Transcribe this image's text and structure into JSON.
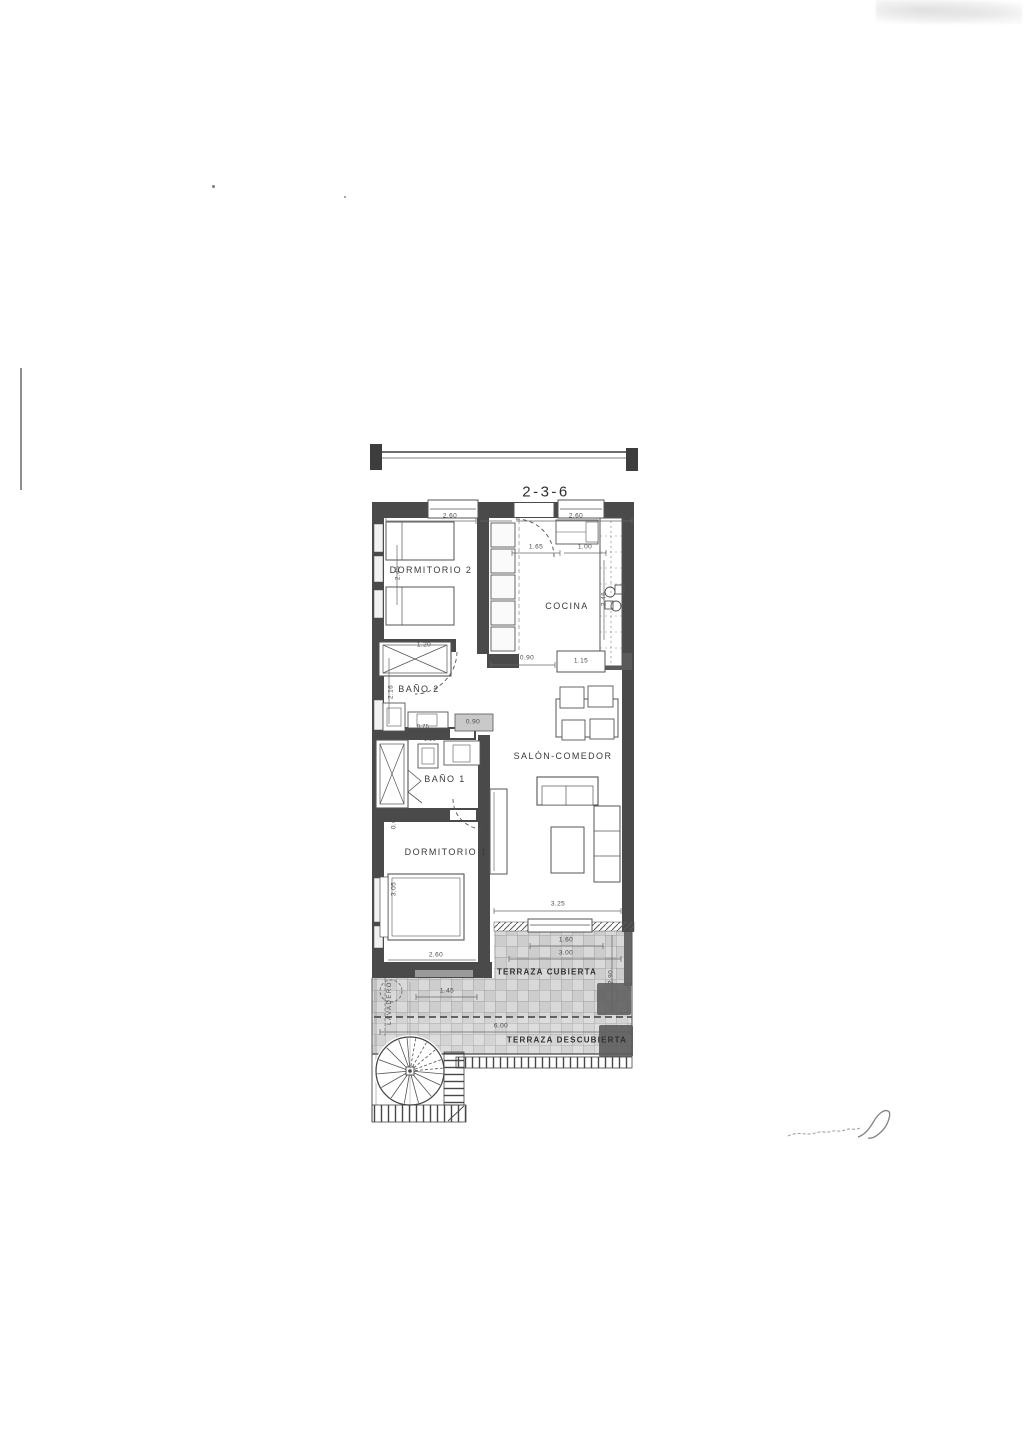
{
  "title": "2-3-6",
  "rooms": {
    "dormitorio2": "DORMITORIO 2",
    "cocina": "COCINA",
    "bano2": "BAÑO 2",
    "bano1": "BAÑO 1",
    "salon": "SALÓN-COMEDOR",
    "dormitorio1": "DORMITORIO 1",
    "terraza_cubierta": "TERRAZA CUBIERTA",
    "terraza_descubierta": "TERRAZA DESCUBIERTA",
    "lavadero": "LAVADERO"
  },
  "dims": {
    "dorm2_width": "2.60",
    "entrance_width": "0.80",
    "cocina_top_width": "2.60",
    "cocina_inner_a": "1.65",
    "cocina_inner_b": "1.00",
    "cocina_depth": "2.46",
    "hall_opening": "0.90",
    "cocina_counter": "1.15",
    "dorm2_depth": "2.45",
    "bathtub_width": "1.20",
    "bano2_depth": "2.16",
    "bano2_vanity": "0.75",
    "hall_cabinet": "0.90",
    "bano1_top": "1.20",
    "bano1_side": "0.60",
    "dorm1_depth": "3.05",
    "salon_opening": "3.25",
    "terraza_door": "1.60",
    "terraza_inner": "3.00",
    "terraza_depth": "2.90",
    "terraza_left": "1.45",
    "terraza_width": "6.00",
    "dorm1_width": "2.60"
  },
  "colors": {
    "wall": "#4a4a4a",
    "ink": "#3c3c3c",
    "tile": "#d9d9d9"
  }
}
